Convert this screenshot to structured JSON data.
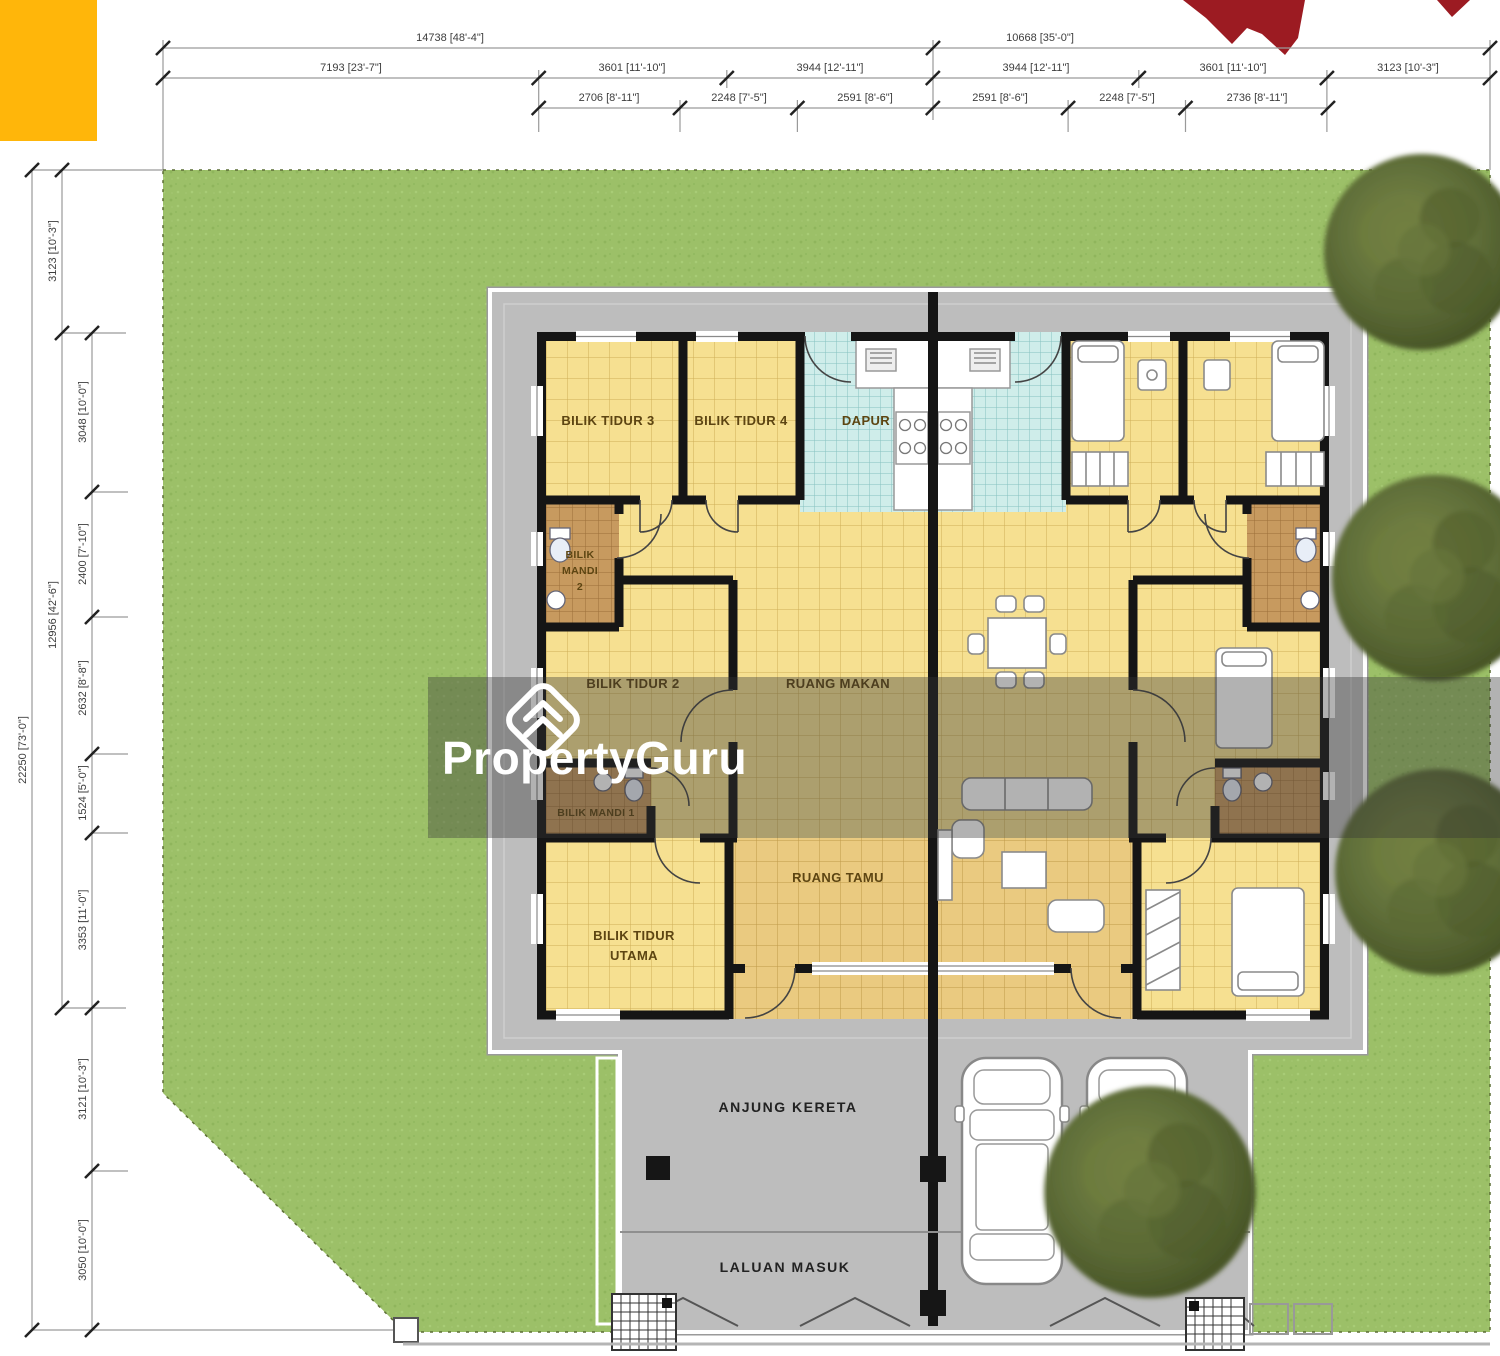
{
  "branding": {
    "watermark": "PropertyGuru"
  },
  "colors": {
    "accent_orange": "#FFB60A",
    "logo_red": "#9C1B22",
    "lawn_green": "#9CC068",
    "pad_gray": "#BDBDBD",
    "bedroom_tile": "#F6E091",
    "kitchen_tile": "#CFEDEA",
    "bath_tile": "#C79A5F",
    "living_tile": "#EACA80",
    "wall_black": "#151515"
  },
  "dims": {
    "top1": [
      "14738 [48'-4\"]",
      "10668 [35'-0\"]"
    ],
    "top2": [
      "7193 [23'-7\"]",
      "3601 [11'-10\"]",
      "3944 [12'-11\"]",
      "3944 [12'-11\"]",
      "3601 [11'-10\"]",
      "3123 [10'-3\"]"
    ],
    "top3": [
      "2706 [8'-11\"]",
      "2248 [7'-5\"]",
      "2591 [8'-6\"]",
      "2591 [8'-6\"]",
      "2248 [7'-5\"]",
      "2736 [8'-11\"]"
    ],
    "left_overall": "22250 [73'-0\"]",
    "left_mid": [
      "3123 [10'-3\"]",
      "12956 [42'-6\"]"
    ],
    "left_inner": [
      "3048 [10'-0\"]",
      "2400 [7'-10\"]",
      "2632 [8'-8\"]",
      "1524 [5'-0\"]",
      "3353 [11'-0\"]",
      "3121 [10'-3\"]",
      "3050 [10'-0\"]"
    ]
  },
  "rooms": {
    "bedroom3": "BILIK TIDUR 3",
    "bedroom4": "BILIK TIDUR 4",
    "kitchen": "DAPUR",
    "bath2_lines": [
      "BILIK",
      "MANDI",
      "2"
    ],
    "bedroom2": "BILIK TIDUR 2",
    "dining": "RUANG MAKAN",
    "bath1": "BILIK MANDI 1",
    "living": "RUANG TAMU",
    "master_lines": [
      "BILIK TIDUR",
      "UTAMA"
    ]
  },
  "site": {
    "car_porch": "ANJUNG KERETA",
    "entrance": "LALUAN MASUK"
  }
}
